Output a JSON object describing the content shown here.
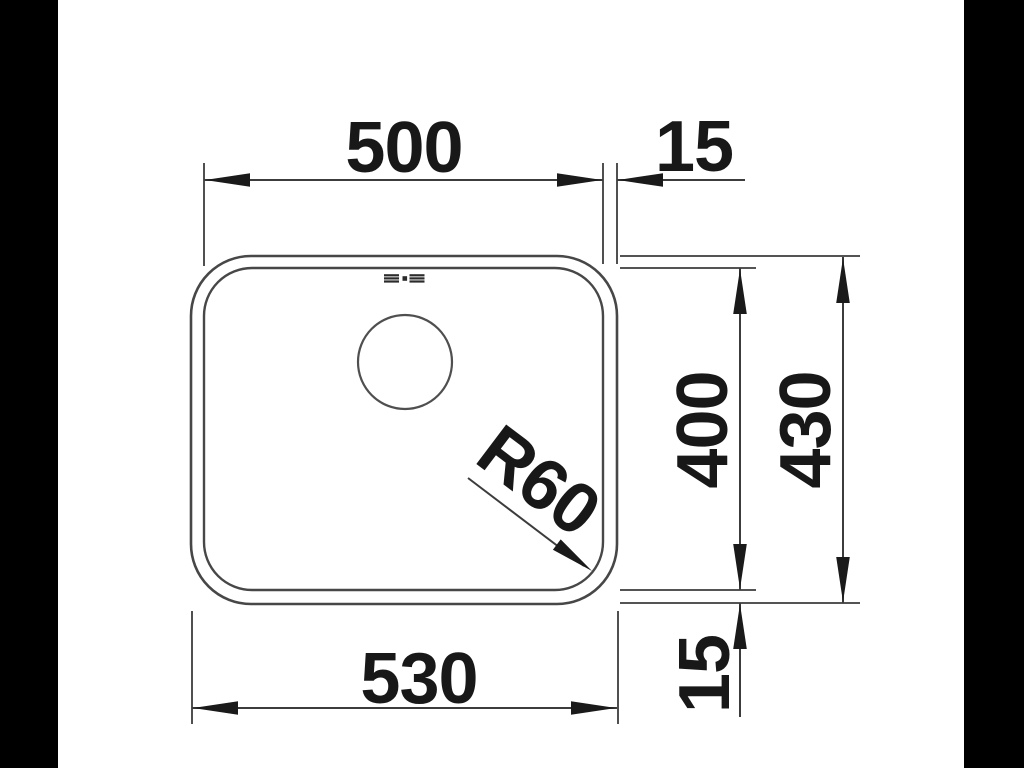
{
  "page": {
    "background": "#ffffff",
    "letterbox_color": "#000000"
  },
  "drawing": {
    "subject": "Undermount sink bowl - dimensioned top view",
    "line_color": "#474747",
    "dimension_line_color": "#3c3c3c",
    "text_color": "#181818",
    "labels": {
      "inner_width": "500",
      "rim_offset_right": "15",
      "outer_width": "530",
      "inner_depth": "400",
      "outer_depth": "430",
      "rim_offset_bottom": "15",
      "corner_radius": "R60"
    }
  }
}
